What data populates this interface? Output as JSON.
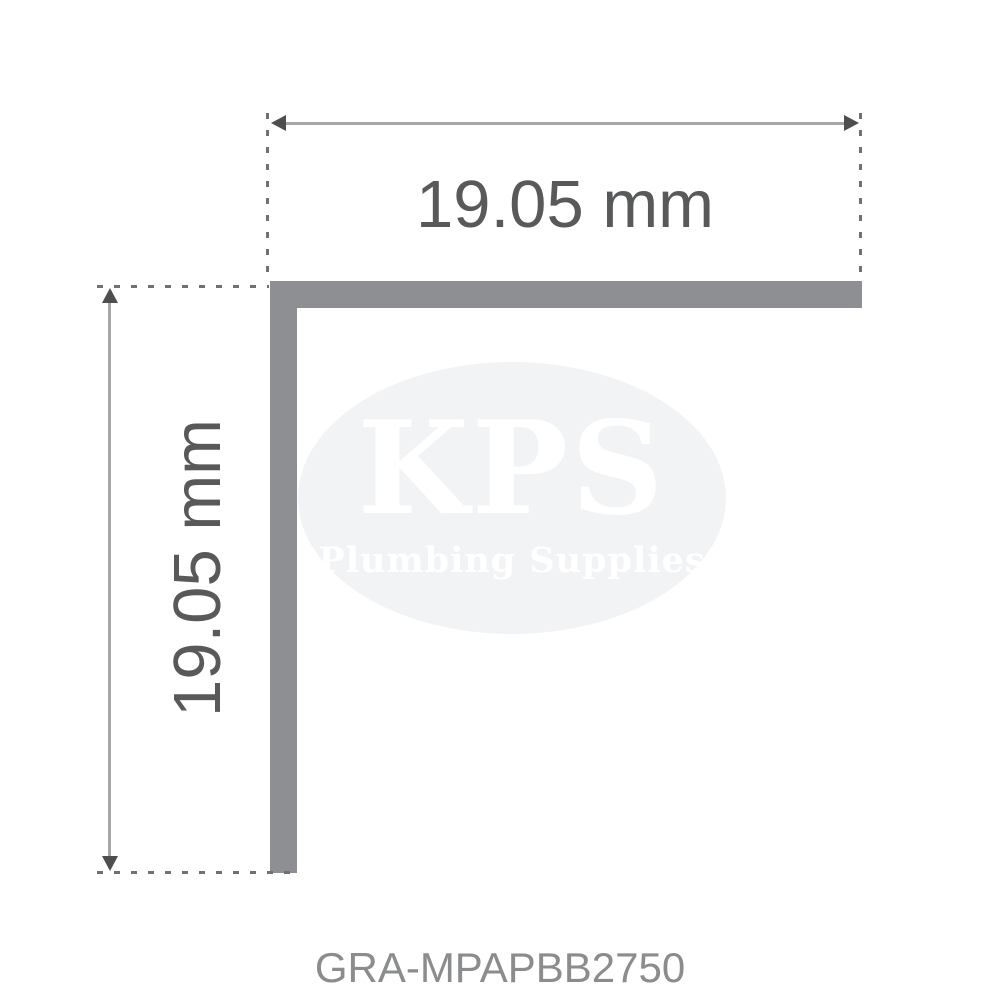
{
  "diagram": {
    "top_dimension": {
      "label": "19.05 mm"
    },
    "left_dimension": {
      "label": "19.05 mm"
    }
  },
  "watermark": {
    "brand": "KPS",
    "tagline": "Plumbing Supplies"
  },
  "product": {
    "code": "GRA-MPAPBB2750"
  },
  "colors": {
    "background": "#ffffff",
    "profile": "#8d8f92",
    "dimension_line": "#a5a7a9",
    "arrowhead": "#4d4e50",
    "extension_line": "#707174",
    "dimension_text": "#58595b",
    "product_code_text": "#8a8c8e",
    "watermark_fill": "#f2f3f5",
    "watermark_text": "#ffffff"
  }
}
